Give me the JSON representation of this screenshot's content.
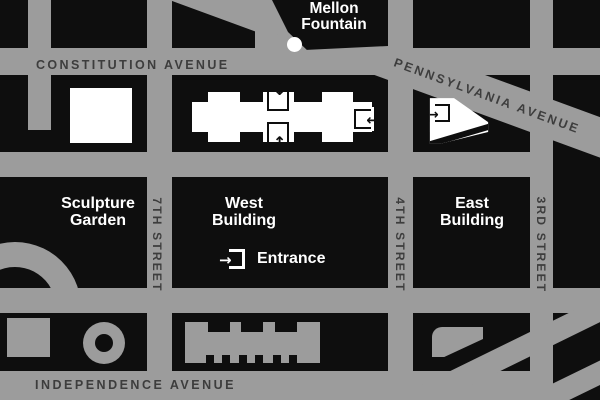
{
  "map": {
    "streets": {
      "constitution": "CONSTITUTION AVENUE",
      "pennsylvania": "PENNSYLVANIA AVENUE",
      "independence": "INDEPENDENCE AVENUE",
      "seventh": "7TH STREET",
      "fourth": "4TH STREET",
      "third": "3RD STREET"
    },
    "places": {
      "mellon_line1": "Mellon",
      "mellon_line2": "Fountain",
      "sculpture_line1": "Sculpture",
      "sculpture_line2": "Garden",
      "west_line1": "West",
      "west_line2": "Building",
      "east_line1": "East",
      "east_line2": "Building",
      "entrance": "Entrance"
    },
    "icons": {
      "arrow_down": "↓",
      "arrow_up": "↑",
      "arrow_left": "←",
      "arrow_right": "→"
    },
    "colors": {
      "road_gray": "#9c9c9c",
      "block_black": "#0e0e0e",
      "road_text": "#3d3d3d",
      "label_white": "#ffffff"
    }
  }
}
